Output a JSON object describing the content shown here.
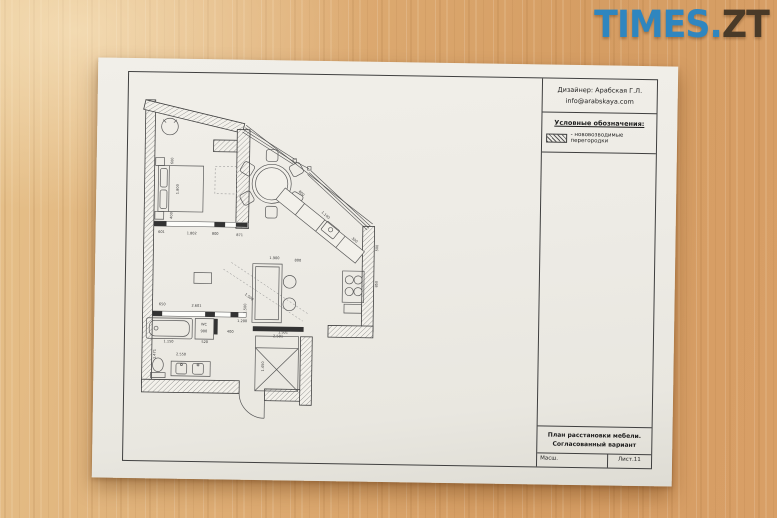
{
  "watermark": {
    "text_primary": "TIMES.",
    "text_secondary": "ZT",
    "primary_color": "#2f86bf",
    "secondary_color": "#493a28"
  },
  "titleblock": {
    "designer_line1": "Дизайнер: Арабская Г.Л.",
    "designer_line2": "info@arabskaya.com",
    "legend_title": "Условные обозначения:",
    "legend_item": "- нововозводимые перегородки",
    "plan_title_line1": "План расстановки мебели.",
    "plan_title_line2": "Согласованный вариант",
    "scale_label": "Масш.",
    "sheet_label": "Лист.11"
  },
  "plan": {
    "labels": [
      {
        "t": "600",
        "x": 35,
        "y": 82,
        "r": -90
      },
      {
        "t": "1.800",
        "x": 41,
        "y": 111,
        "r": -90
      },
      {
        "t": "400",
        "x": 35,
        "y": 138,
        "r": -90
      },
      {
        "t": "601",
        "x": 24,
        "y": 156,
        "r": 0
      },
      {
        "t": "1.802",
        "x": 55,
        "y": 157,
        "r": 0
      },
      {
        "t": "800",
        "x": 79,
        "y": 157,
        "r": 0
      },
      {
        "t": "871",
        "x": 104,
        "y": 158,
        "r": 0
      },
      {
        "t": "800",
        "x": 166,
        "y": 114,
        "r": 42
      },
      {
        "t": "1.100",
        "x": 191,
        "y": 136,
        "r": 40
      },
      {
        "t": "300",
        "x": 221,
        "y": 161,
        "r": 40
      },
      {
        "t": "500",
        "x": 246,
        "y": 168,
        "r": -90
      },
      {
        "t": "850",
        "x": 246,
        "y": 205,
        "r": -90
      },
      {
        "t": "1.900",
        "x": 140,
        "y": 181,
        "r": 0
      },
      {
        "t": "800",
        "x": 164,
        "y": 183,
        "r": 0
      },
      {
        "t": "1.500",
        "x": 112,
        "y": 232,
        "r": -90
      },
      {
        "t": "2.501",
        "x": 145,
        "y": 261,
        "r": 0
      },
      {
        "t": "650",
        "x": 26,
        "y": 230,
        "r": 0
      },
      {
        "t": "2.601",
        "x": 61,
        "y": 231,
        "r": 0
      },
      {
        "t": "WC",
        "x": 69,
        "y": 250,
        "r": 0
      },
      {
        "t": "900",
        "x": 69,
        "y": 257,
        "r": 0
      },
      {
        "t": "520",
        "x": 70,
        "y": 268,
        "r": 0
      },
      {
        "t": "1.150",
        "x": 33,
        "y": 268,
        "r": 0
      },
      {
        "t": "1.471",
        "x": 20,
        "y": 280,
        "r": -90
      },
      {
        "t": "2.550",
        "x": 46,
        "y": 281,
        "r": 0
      },
      {
        "t": "400",
        "x": 96,
        "y": 257,
        "r": 0
      },
      {
        "t": "1.200",
        "x": 108,
        "y": 246,
        "r": 0
      },
      {
        "t": "1.501",
        "x": 150,
        "y": 257,
        "r": 0
      },
      {
        "t": "1.500",
        "x": 114,
        "y": 221,
        "r": 38
      },
      {
        "t": "1.450",
        "x": 131,
        "y": 291,
        "r": -90
      }
    ]
  }
}
